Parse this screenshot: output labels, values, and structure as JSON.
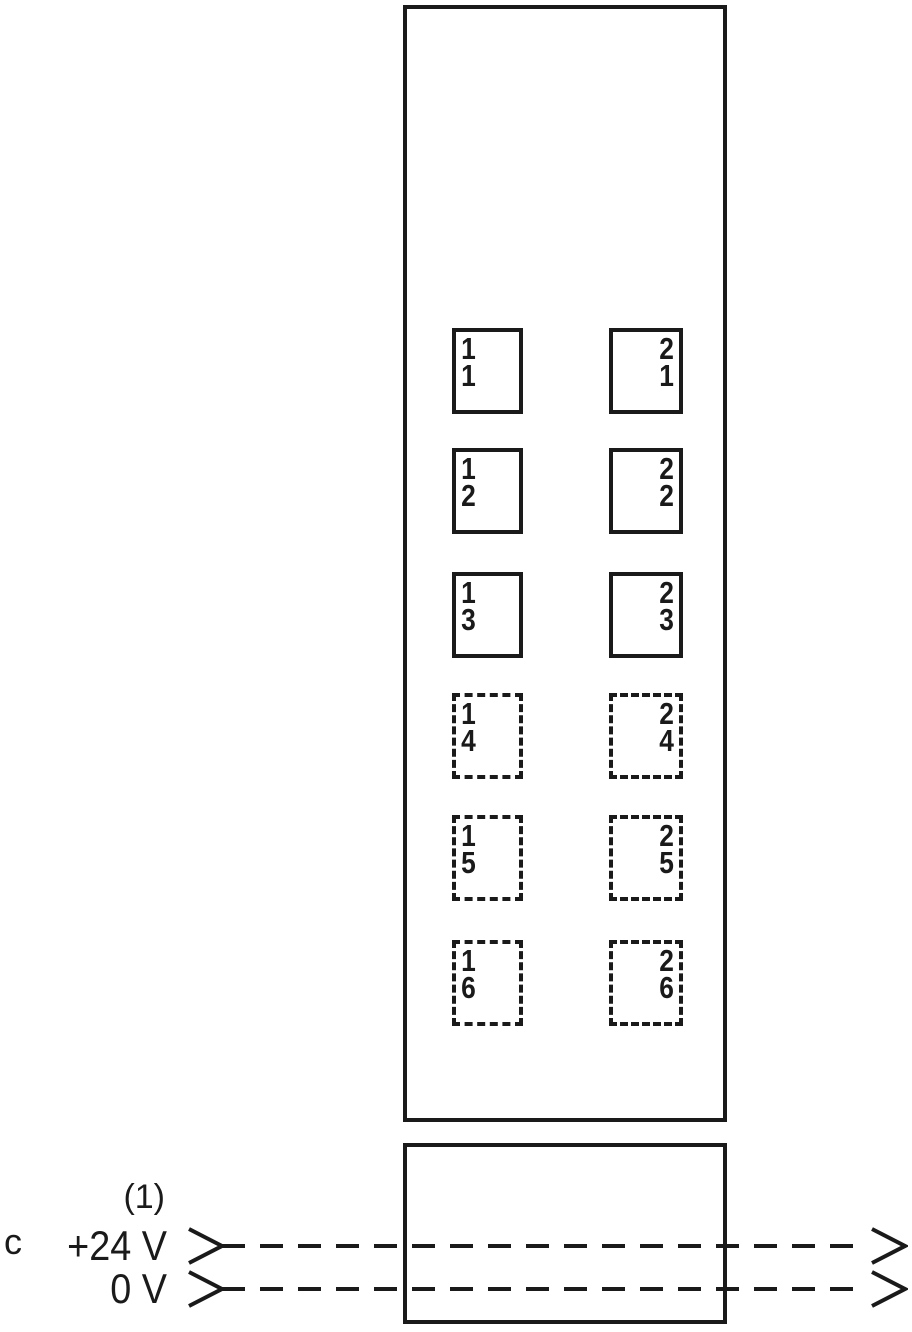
{
  "module": {
    "columns": [
      {
        "id": "1",
        "connectors": [
          {
            "line1": "1",
            "line2": "1",
            "style": "solid"
          },
          {
            "line1": "1",
            "line2": "2",
            "style": "solid"
          },
          {
            "line1": "1",
            "line2": "3",
            "style": "solid"
          },
          {
            "line1": "1",
            "line2": "4",
            "style": "dashed"
          },
          {
            "line1": "1",
            "line2": "5",
            "style": "dashed"
          },
          {
            "line1": "1",
            "line2": "6",
            "style": "dashed"
          }
        ]
      },
      {
        "id": "2",
        "connectors": [
          {
            "line1": "2",
            "line2": "1",
            "style": "solid"
          },
          {
            "line1": "2",
            "line2": "2",
            "style": "solid"
          },
          {
            "line1": "2",
            "line2": "3",
            "style": "solid"
          },
          {
            "line1": "2",
            "line2": "4",
            "style": "dashed"
          },
          {
            "line1": "2",
            "line2": "5",
            "style": "dashed"
          },
          {
            "line1": "2",
            "line2": "6",
            "style": "dashed"
          }
        ]
      }
    ]
  },
  "power": {
    "callout": "(1)",
    "figure_label": "c",
    "lines": [
      {
        "label": "+24 V"
      },
      {
        "label": "0 V"
      }
    ]
  },
  "colors": {
    "stroke": "#1a1a1a",
    "background": "#ffffff"
  }
}
